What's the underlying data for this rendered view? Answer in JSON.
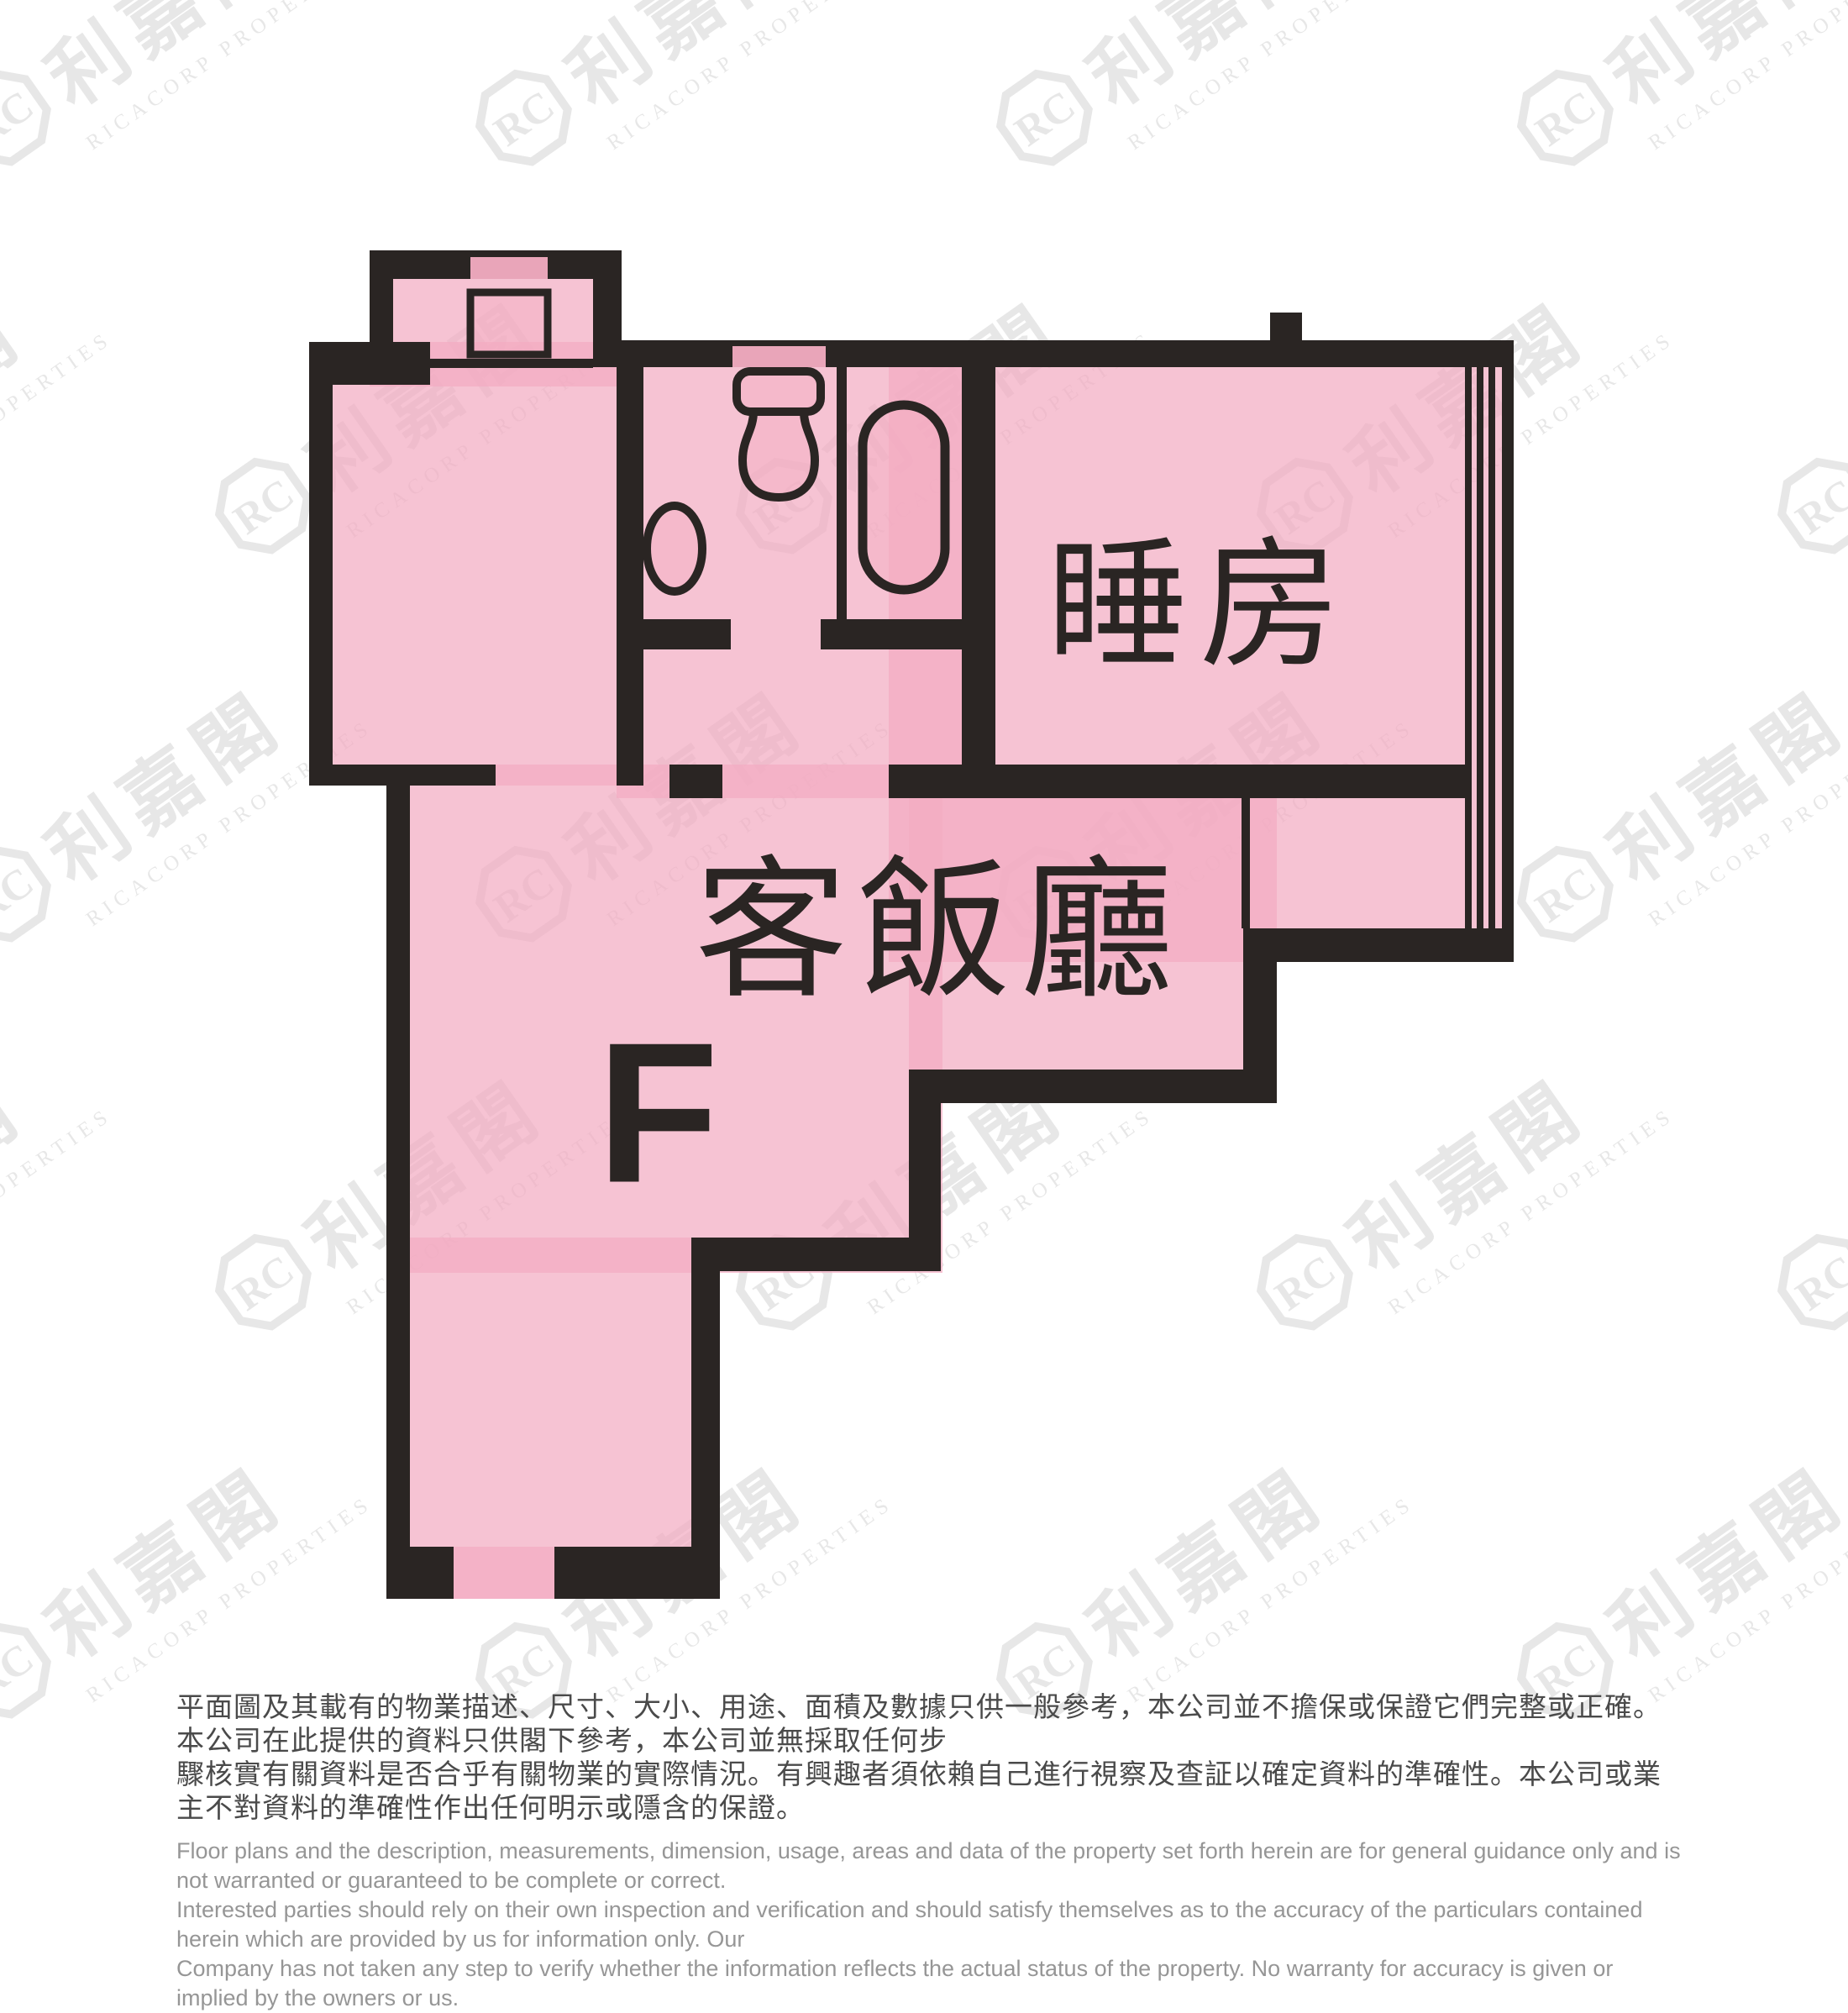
{
  "floor_plan": {
    "unit_label": "F",
    "rooms": [
      {
        "id": "bedroom",
        "label": "睡房"
      },
      {
        "id": "living_dining",
        "label": "客飯廳"
      }
    ],
    "fixtures": [
      "stove-square",
      "toilet",
      "wash-basin",
      "bathtub",
      "window-glazing"
    ],
    "colors": {
      "wall": "#2A2523",
      "room_fill": "#F6C3D3",
      "label": "#2A2523"
    }
  },
  "watermark": {
    "logo_text": "RC",
    "cjk_text": "利嘉閣",
    "latin_text": "RICACORP PROPERTIES"
  },
  "disclaimer": {
    "zh_lines": [
      "平面圖及其載有的物業描述、尺寸、大小、用途、面積及數據只供一般參考，本公司並不擔保或保證它們完整或正確。本公司在此提供的資料只供閣下參考，本公司並無採取任何步",
      "驟核實有關資料是否合乎有關物業的實際情況。有興趣者須依賴自己進行視察及查証以確定資料的準確性。本公司或業主不對資料的準確性作出任何明示或隱含的保證。"
    ],
    "en_lines": [
      "Floor plans and the description, measurements, dimension, usage, areas and data of the property set forth herein are for general guidance only and is not warranted or guaranteed to be complete or correct.",
      "Interested parties should rely on their own inspection and verification and should satisfy themselves as to the accuracy of the particulars contained herein which are provided by us for information only.  Our",
      "Company has not taken any step to verify whether the information reflects the actual status of the property.  No warranty for accuracy is given or implied by the owners or us."
    ]
  }
}
